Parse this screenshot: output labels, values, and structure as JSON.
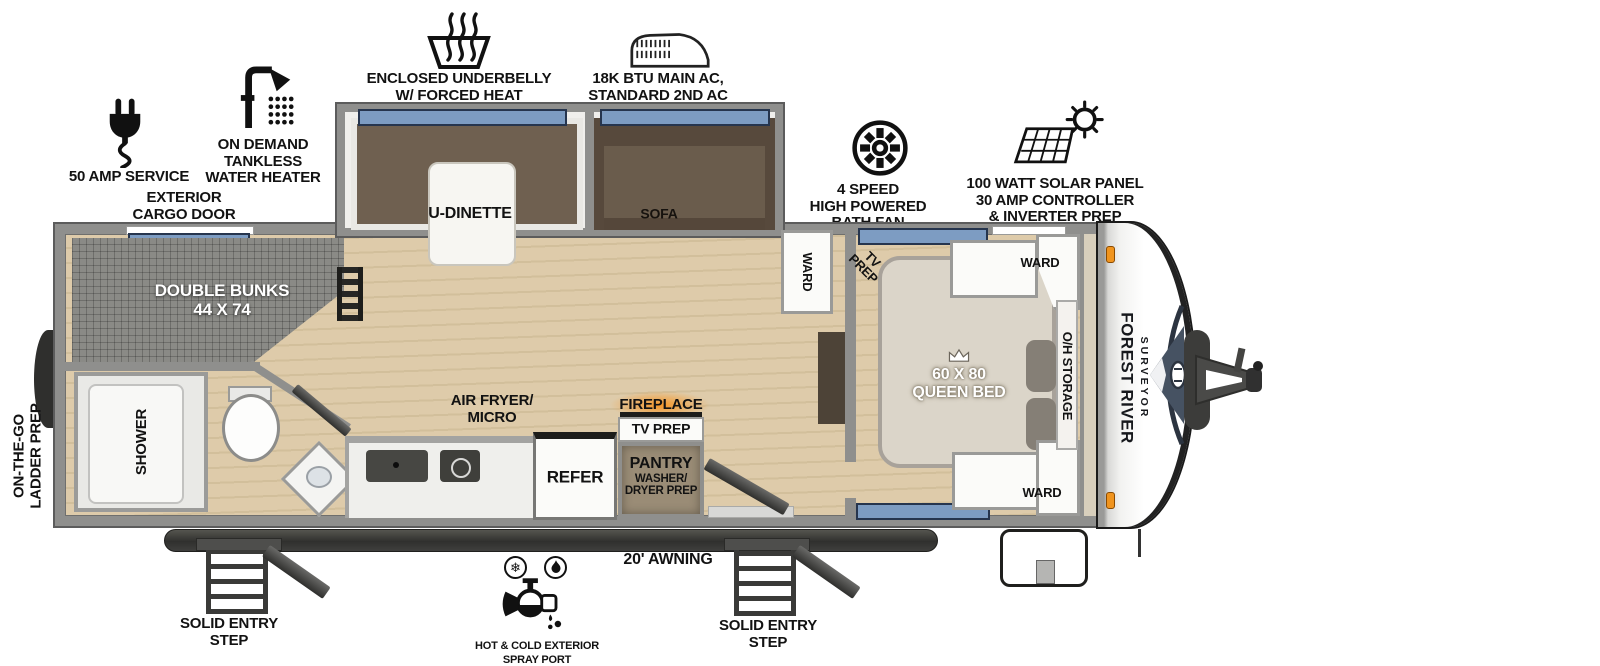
{
  "callouts": [
    {
      "name": "50-amp-service",
      "lines": [
        "50 AMP SERVICE"
      ]
    },
    {
      "name": "tankless-water-heater",
      "lines": [
        "ON DEMAND",
        "TANKLESS",
        "WATER HEATER"
      ]
    },
    {
      "name": "enclosed-underbelly",
      "lines": [
        "ENCLOSED UNDERBELLY",
        "W/ FORCED HEAT"
      ]
    },
    {
      "name": "main-ac",
      "lines": [
        "18K BTU MAIN AC,",
        "STANDARD 2ND AC"
      ]
    },
    {
      "name": "bath-fan",
      "lines": [
        "4 SPEED",
        "HIGH POWERED",
        "BATH FAN"
      ]
    },
    {
      "name": "solar-panel",
      "lines": [
        "100 WATT SOLAR PANEL",
        "30 AMP CONTROLLER",
        "& INVERTER PREP"
      ]
    }
  ],
  "exterior": {
    "cargo_door": [
      "EXTERIOR",
      "CARGO DOOR"
    ],
    "ladder_prep": [
      "ON-THE-GO",
      "LADDER PREP"
    ],
    "awning": "20' AWNING",
    "entry_step_left": [
      "SOLID ENTRY",
      "STEP"
    ],
    "entry_step_right": [
      "SOLID ENTRY",
      "STEP"
    ],
    "spray_port": [
      "HOT & COLD EXTERIOR",
      "SPRAY PORT"
    ]
  },
  "rooms": {
    "bunks": [
      "DOUBLE BUNKS",
      "44 X 74"
    ],
    "shower": "SHOWER",
    "dinette": "U-DINETTE",
    "sofa": "SOFA",
    "air_fryer": [
      "AIR FRYER/",
      "MICRO"
    ],
    "refer": "REFER",
    "fireplace": "FIREPLACE",
    "tv_prep_main": "TV PREP",
    "pantry": [
      "PANTRY",
      "WASHER/",
      "DRYER PREP"
    ],
    "ward_hall": "WARD",
    "tv_prep_bedroom": [
      "TV",
      "PREP"
    ],
    "queen_bed": [
      "60 X 80",
      "QUEEN BED"
    ],
    "ward_bed_top": "WARD",
    "ward_bed_bottom": "WARD",
    "oh_storage": "O/H STORAGE"
  },
  "brand": {
    "make": "FOREST RIVER",
    "model": "SURVEYOR"
  },
  "colors": {
    "window_blue": "#7d9cc2",
    "awning_dark": "#3a3a38",
    "accent_orange": "#f0941e",
    "fireplace_glow": "#f79421",
    "wood_floor": "#dcc9a7",
    "mattress_gray": "#8a8a86",
    "cushion_brown": "#6f6050",
    "bed_beige": "#dbd5c9",
    "wall_gray": "#8f8f8d"
  }
}
